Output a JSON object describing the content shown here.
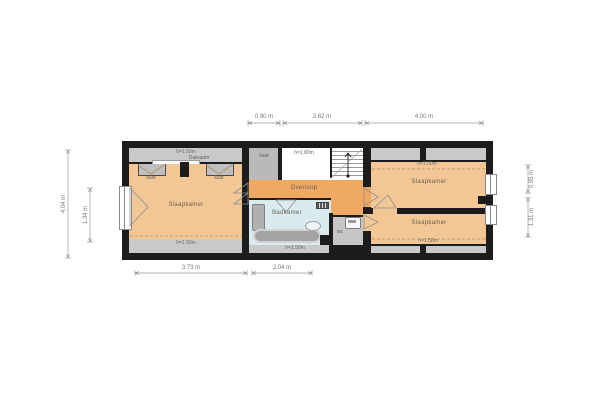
{
  "plan_type": "floor-plan (verdieping)",
  "rooms": {
    "bedroom_left": "Slaapkamer",
    "landing": "Overloop",
    "bathroom": "Badkamer",
    "bedroom_top_right": "Slaapkamer",
    "bedroom_bottom_right": "Slaapkamer"
  },
  "small_labels": {
    "closet_left_a": "kast",
    "closet_left_b": "kast",
    "closet_stairs": "kast",
    "wc": "wc",
    "dormer": "Dakraam"
  },
  "headroom": {
    "left_top": "h=1.50m",
    "left_bottom": "h=1.50m",
    "stairs": "h=1.80m",
    "bathroom_bottom": "h=1.50m",
    "right_top": "h=1.50m",
    "right_bottom": "h=1.50m"
  },
  "dimensions": {
    "top": [
      "0.90 m",
      "2.62 m",
      "4.00 m"
    ],
    "bottom": [
      "3.73 m",
      "2.04 m"
    ],
    "left": [
      "4.04 m",
      "1.34 m"
    ],
    "right": [
      "0.95 m",
      "1.31 m"
    ]
  },
  "colors": {
    "wall": "#1c1c1c",
    "room_orange": "#f3c795",
    "landing_orange": "#efa963",
    "bathroom_blue": "#d9ebef",
    "underroof_gray": "#c9c9c9",
    "fixture_gray": "#a3a3a3",
    "dimension_text": "#777777"
  }
}
